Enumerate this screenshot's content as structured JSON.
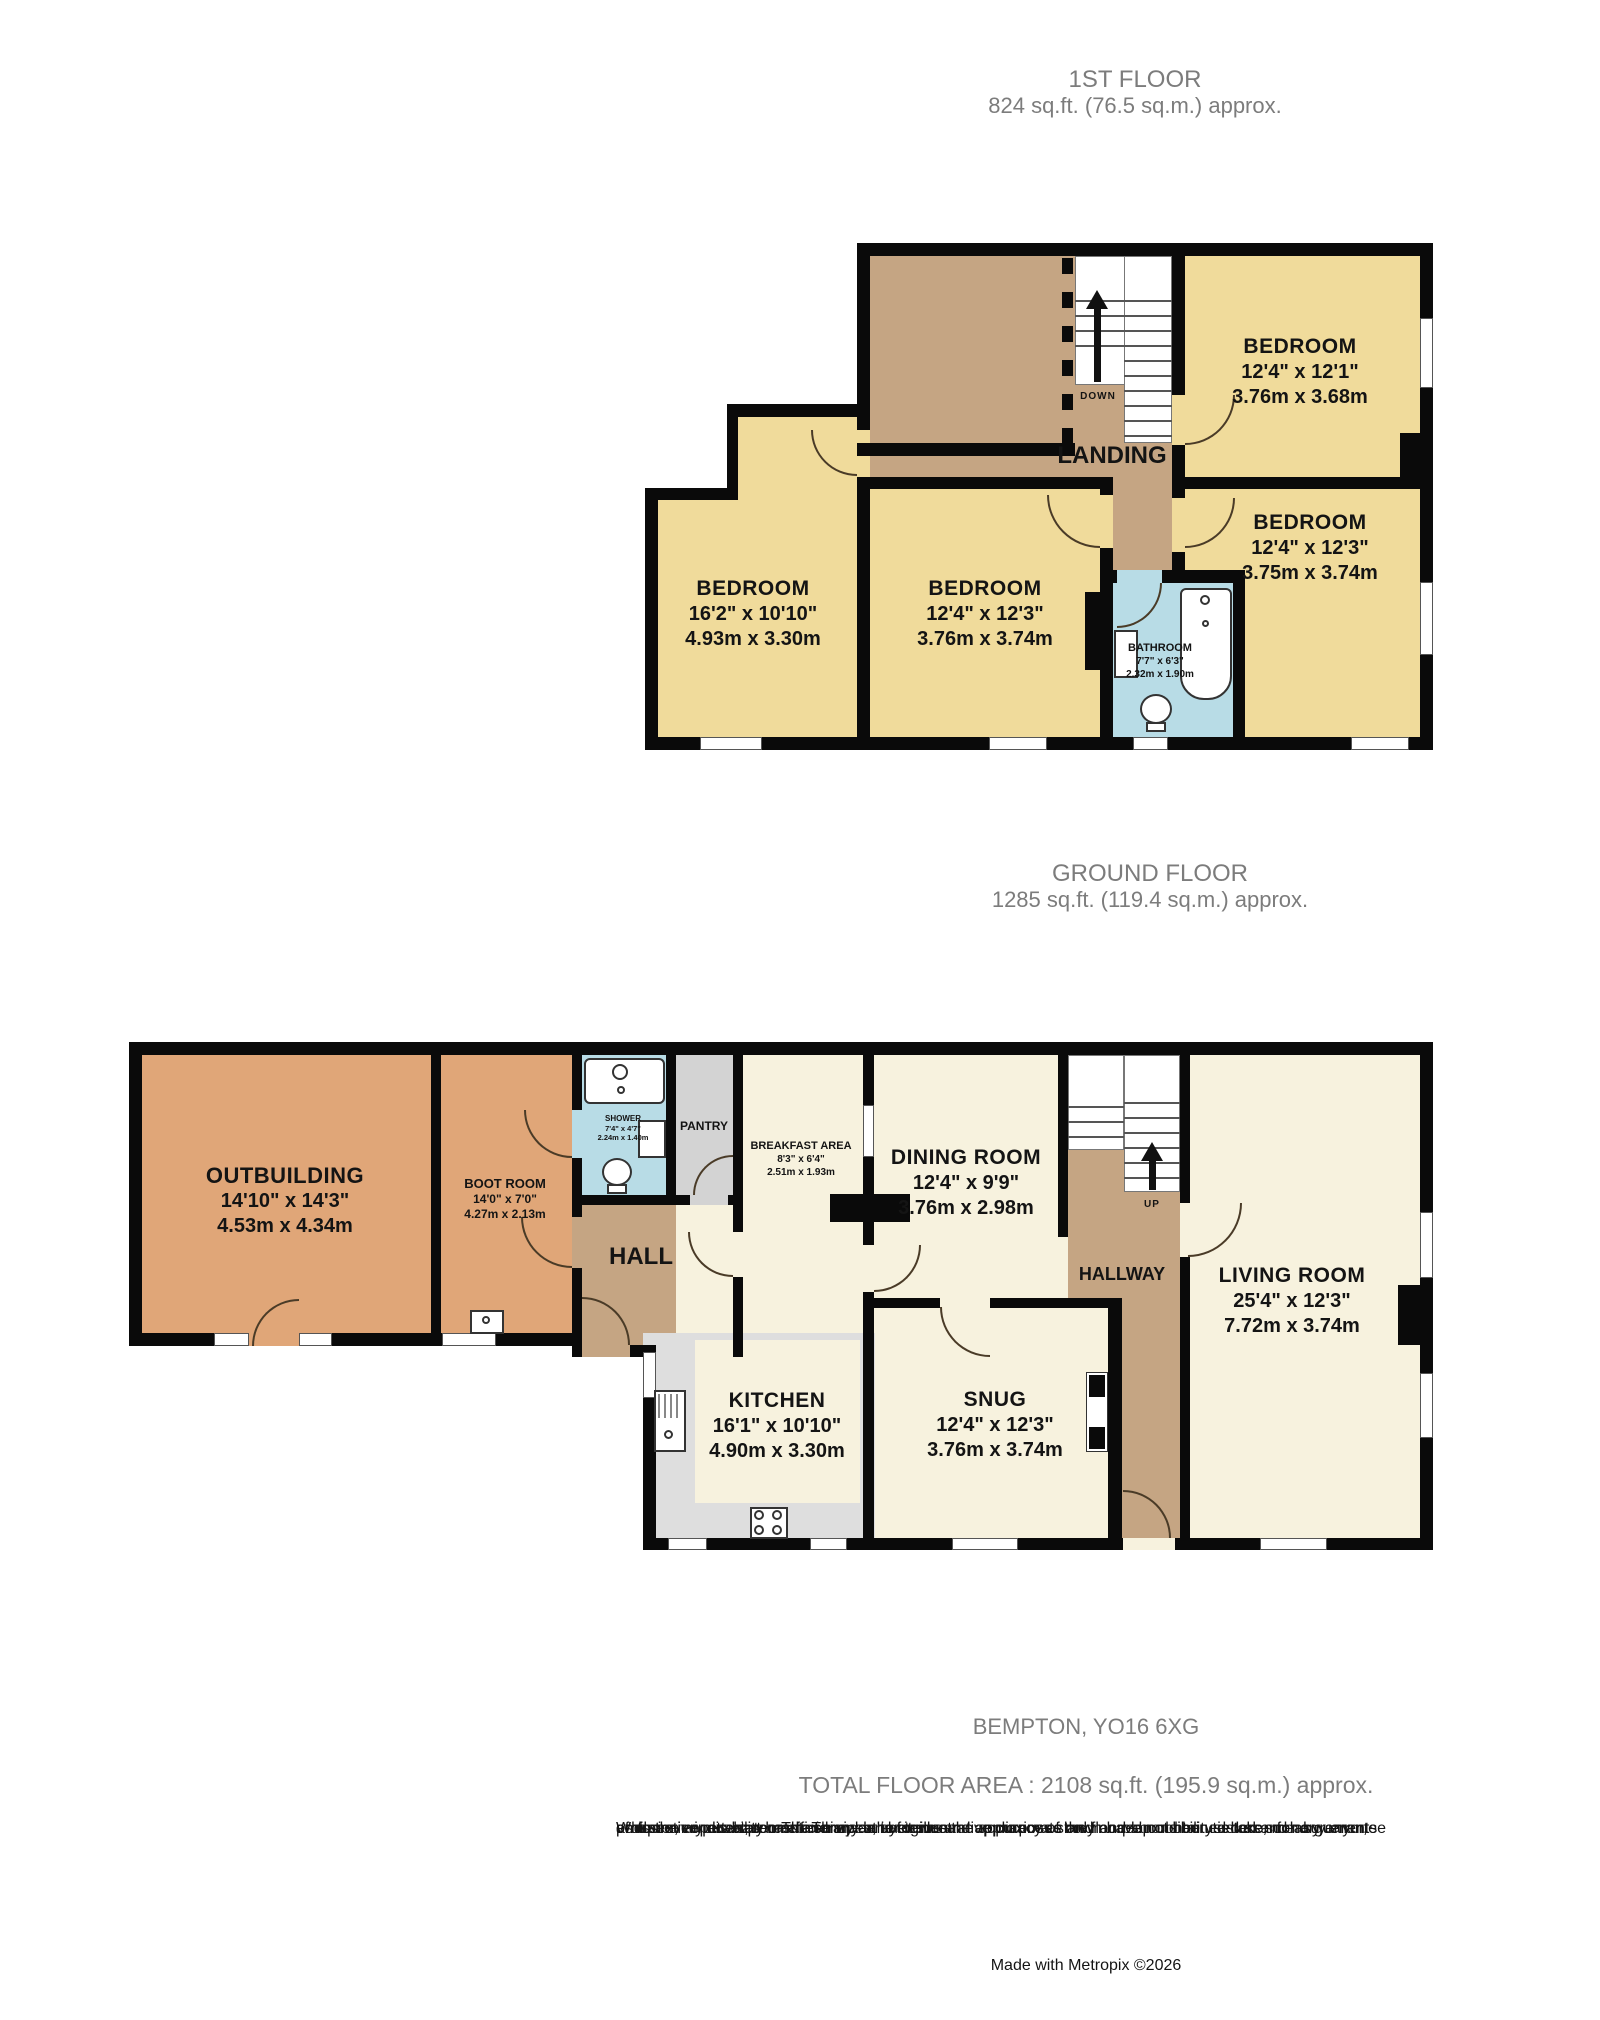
{
  "first_floor": {
    "title": "1ST FLOOR",
    "area": "824 sq.ft. (76.5 sq.m.) approx.",
    "stair_label": "DOWN",
    "rooms": {
      "bedroom_top_right": {
        "name": "BEDROOM",
        "dims_ft": "12'4\" x 12'1\"",
        "dims_m": "3.76m x 3.68m"
      },
      "bedroom_left": {
        "name": "BEDROOM",
        "dims_ft": "16'2\" x 10'10\"",
        "dims_m": "4.93m x 3.30m"
      },
      "bedroom_middle": {
        "name": "BEDROOM",
        "dims_ft": "12'4\" x 12'3\"",
        "dims_m": "3.76m x 3.74m"
      },
      "bedroom_right": {
        "name": "BEDROOM",
        "dims_ft": "12'4\" x 12'3\"",
        "dims_m": "3.75m x 3.74m"
      },
      "bathroom": {
        "name": "BATHROOM",
        "dims_ft": "7'7\" x 6'3\"",
        "dims_m": "2.32m x 1.90m"
      },
      "landing": {
        "name": "LANDING"
      }
    }
  },
  "ground_floor": {
    "title": "GROUND FLOOR",
    "area": "1285 sq.ft. (119.4 sq.m.) approx.",
    "stair_label": "UP",
    "rooms": {
      "outbuilding": {
        "name": "OUTBUILDING",
        "dims_ft": "14'10\" x 14'3\"",
        "dims_m": "4.53m x 4.34m"
      },
      "boot_room": {
        "name": "BOOT ROOM",
        "dims_ft": "14'0\" x 7'0\"",
        "dims_m": "4.27m x 2.13m"
      },
      "shower": {
        "name": "SHOWER",
        "dims_ft": "7'4\" x 4'7\"",
        "dims_m": "2.24m x 1.40m"
      },
      "pantry": {
        "name": "PANTRY"
      },
      "hall": {
        "name": "HALL"
      },
      "breakfast_area": {
        "name": "BREAKFAST AREA",
        "dims_ft": "8'3\" x 6'4\"",
        "dims_m": "2.51m x 1.93m"
      },
      "dining_room": {
        "name": "DINING ROOM",
        "dims_ft": "12'4\" x 9'9\"",
        "dims_m": "3.76m x 2.98m"
      },
      "hallway": {
        "name": "HALLWAY"
      },
      "living_room": {
        "name": "LIVING ROOM",
        "dims_ft": "25'4\" x 12'3\"",
        "dims_m": "7.72m x 3.74m"
      },
      "kitchen": {
        "name": "KITCHEN",
        "dims_ft": "16'1\" x 10'10\"",
        "dims_m": "4.90m x 3.30m"
      },
      "snug": {
        "name": "SNUG",
        "dims_ft": "12'4\" x 12'3\"",
        "dims_m": "3.76m x 3.74m"
      }
    }
  },
  "footer": {
    "address": "BEMPTON, YO16 6XG",
    "total_area": "TOTAL FLOOR AREA : 2108 sq.ft. (195.9 sq.m.) approx.",
    "disclaimer": [
      "Whilst every attempt has been made to ensure the accuracy of the floorplan contained here, measurements",
      "of doors, windows, rooms and any other items are approximate and no responsibility is taken for any error,",
      "omission or mis-statement. This plan is for illustrative purposes only and should be used as such by any",
      "prospective purchaser. The services, systems and appliances shown have not been tested and no guarantee",
      "as to their operability or efficiency can be given."
    ],
    "credit": "Made with Metropix ©2026"
  },
  "colors": {
    "wall": "#0a0a0a",
    "bedroom_fill": "#F0DB9B",
    "landing_fill": "#C5A583",
    "bathroom_fill": "#B8DCE6",
    "outbuilding_fill": "#E0A678",
    "reception_fill": "#F7F2DE",
    "kitchen_fill": "#DEDEDE",
    "pantry_fill": "#D3D3D3"
  }
}
